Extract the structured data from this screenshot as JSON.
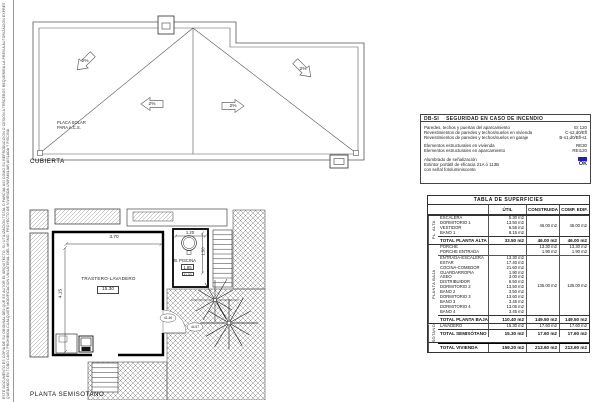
{
  "margin_note_1": "ESTE DOCUMENTO ES COPIA DE SU ORIGINAL DEL QUE ES AUTOR EL ARQUITECTO. SU UTILIZACION TOTAL O PARCIAL ASI COMO SU REPRODUCCION O CESION A TERCEROS REQUERIRA LA PREVIA AUTORIZACION EXPRESA DEL AUTOR",
  "margin_note_2": "QUEDANDO EN TODO CASO PROHIBIDA CUALQUIER MODIFICACION UNILATERAL DEL MISMO. PROYECTO DE VIVIENDA UNIFAMILIAR AISLADA Y PISCINA",
  "roof": {
    "label": "CUBIERTA",
    "solar_label_line1": "PLACA SOLAR",
    "solar_label_line2": "PARA A.C.S.",
    "slope_labels": [
      "2%",
      "2%",
      "2%",
      "2%"
    ]
  },
  "basement": {
    "label": "PLANTA SEMISOTANO",
    "room_label": "TRASTERO-LAVADERO",
    "room_area": "15.30",
    "dim_width": "3.70",
    "dim_height": "4.15",
    "pool_label": "B. PISCINA",
    "pool_dim": "1.20",
    "pool_dim_right": "1.50",
    "pool_area": "1.85",
    "pool_level": "41.30",
    "level_door": "41.46",
    "level_terrace": "44.57"
  },
  "fire_box": {
    "code": "DB-SI",
    "title": "SEGURIDAD EN CASO DE INCENDIO",
    "paragraphs": [
      [
        {
          "label": "Paredes, techos y puertas del aparcamiento",
          "value": "EI 120"
        },
        {
          "label": "Revestimientos de paredes y techos/suelos en vivienda",
          "value": "C-s2,d0/Efl"
        },
        {
          "label": "Revestimientos de paredes y techos/suelos en garaje",
          "value": "B-s1,d0/Bfl-s1"
        }
      ],
      [
        {
          "label": "Elementos estructurales en vivienda",
          "value": "RE30"
        },
        {
          "label": "Elementos estructurales en aparcamiento",
          "value": "REI120"
        }
      ],
      [
        {
          "label": "Alumbrado de señalización",
          "icon": "emergency-light-icon"
        },
        {
          "label": "Extintor portátil de eficacia 21A ó 113B",
          "value": "OK",
          "strong": true
        },
        {
          "label": "con señal fotoluminiscente",
          "value": ""
        }
      ]
    ]
  },
  "surfaces_table": {
    "title": "TABLA DE SUPERFICIES",
    "col_headers": [
      "ÚTIL",
      "CONSTRUIDA",
      "COMP. EDIF."
    ],
    "groups": [
      {
        "side_label": "PL. ALTA",
        "blocks": [
          {
            "rows": [
              {
                "name": "ESCALERA",
                "util": "5.30 m2"
              },
              {
                "name": "DORMITORIO 1",
                "util": "13.50 m2"
              },
              {
                "name": "VESTIDOR",
                "util": "6.55 m2"
              },
              {
                "name": "BAÑO 1",
                "util": "8.15 m2"
              }
            ],
            "construida": "46.00 m2",
            "comp": "46.00 m2"
          }
        ],
        "totals": [
          {
            "name": "TOTAL PLANTA ALTA",
            "util": "33.50 m2",
            "construida": "46.00 m2",
            "comp": "46.00 m2"
          }
        ]
      },
      {
        "side_label": "PLANTA BAJA",
        "blocks": [
          {
            "rows": [
              {
                "name": "PORCHE",
                "construida": "13.30 m2",
                "comp": "13.30 m2"
              },
              {
                "name": "PORCHE ENTRADA",
                "construida": "1.90 m2",
                "comp": "1.90 m2"
              }
            ]
          },
          {
            "rows": [
              {
                "name": "ENTRADA-ESCALERA",
                "util": "13.30 m2"
              },
              {
                "name": "ESTAR",
                "util": "17.40 m2"
              },
              {
                "name": "COCINA-COMEDOR",
                "util": "21.60 m2"
              },
              {
                "name": "GUARDARROPÍA",
                "util": "1.90 m2"
              },
              {
                "name": "ASEO",
                "util": "3.00 m2"
              },
              {
                "name": "DISTRIBUIDOR",
                "util": "6.50 m2"
              },
              {
                "name": "DORMITORIO 2",
                "util": "13.50 m2"
              },
              {
                "name": "BAÑO 2",
                "util": "3.50 m2"
              },
              {
                "name": "DORMITORIO 3",
                "util": "13.60 m2"
              },
              {
                "name": "BAÑO 3",
                "util": "3.45 m2"
              },
              {
                "name": "DORMITORIO 4",
                "util": "13.05 m2"
              },
              {
                "name": "BAÑO 4",
                "util": "3.45 m2"
              }
            ],
            "construida": "135.00 m2",
            "comp": "135.00 m2"
          }
        ],
        "totals": [
          {
            "name": "TOTAL PLANTA BAJA",
            "util": "110.40 m2",
            "construida": "149.50 m2",
            "comp": "149.50 m2"
          }
        ]
      },
      {
        "side_label": "SÓTANO",
        "blocks": [
          {
            "rows": [
              {
                "name": "LAVADERO",
                "util": "15.30 m2",
                "construida": "17.60 m2",
                "comp": "17.60 m2"
              }
            ]
          }
        ],
        "totals": [
          {
            "name": "TOTAL SEMISÓTANO",
            "util": "15.30 m2",
            "construida": "17.60 m2",
            "comp": "17.60 m2"
          }
        ]
      },
      {
        "side_label": "",
        "blocks": [],
        "totals": [
          {
            "name": "TOTAL VIVIENDA",
            "util": "159.20 m2",
            "construida": "213.60 m2",
            "comp": "213.60 m2",
            "grand": true
          }
        ]
      }
    ]
  }
}
